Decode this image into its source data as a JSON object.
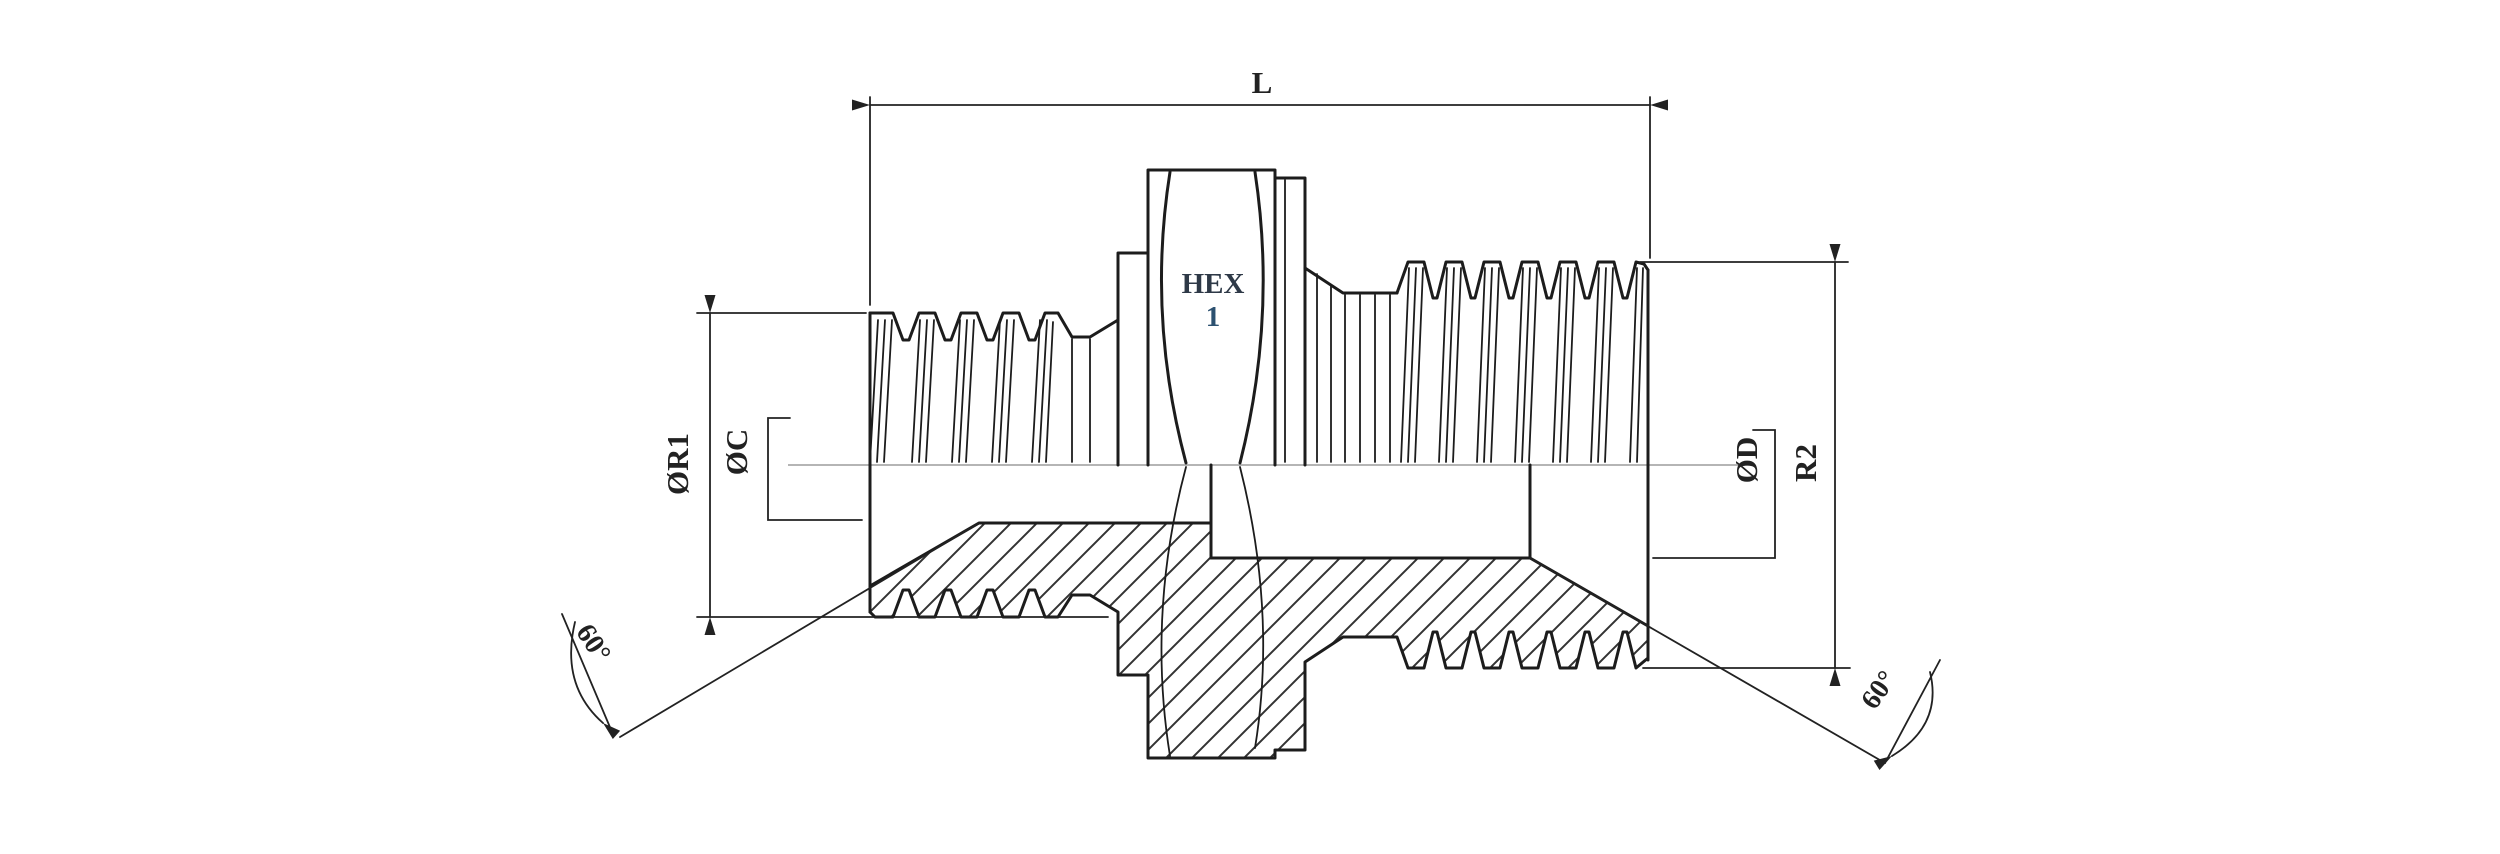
{
  "title": "Male adapter fitting technical drawing (half-section view)",
  "colors": {
    "outline": "#1c1c1c",
    "centerline": "#b5b5b5",
    "dim": "#222222",
    "hatch": "#333333",
    "hex_text": "#2e3947",
    "hex_num": "#2c5170",
    "background": "#ffffff"
  },
  "labels": {
    "length": "L",
    "hex_word": "HEX",
    "hex_size": "1",
    "dia_r1": "ØR1",
    "dia_c": "ØC",
    "dia_d": "ØD",
    "r2": "R2",
    "angle_left": "60°",
    "angle_right": "60°"
  }
}
